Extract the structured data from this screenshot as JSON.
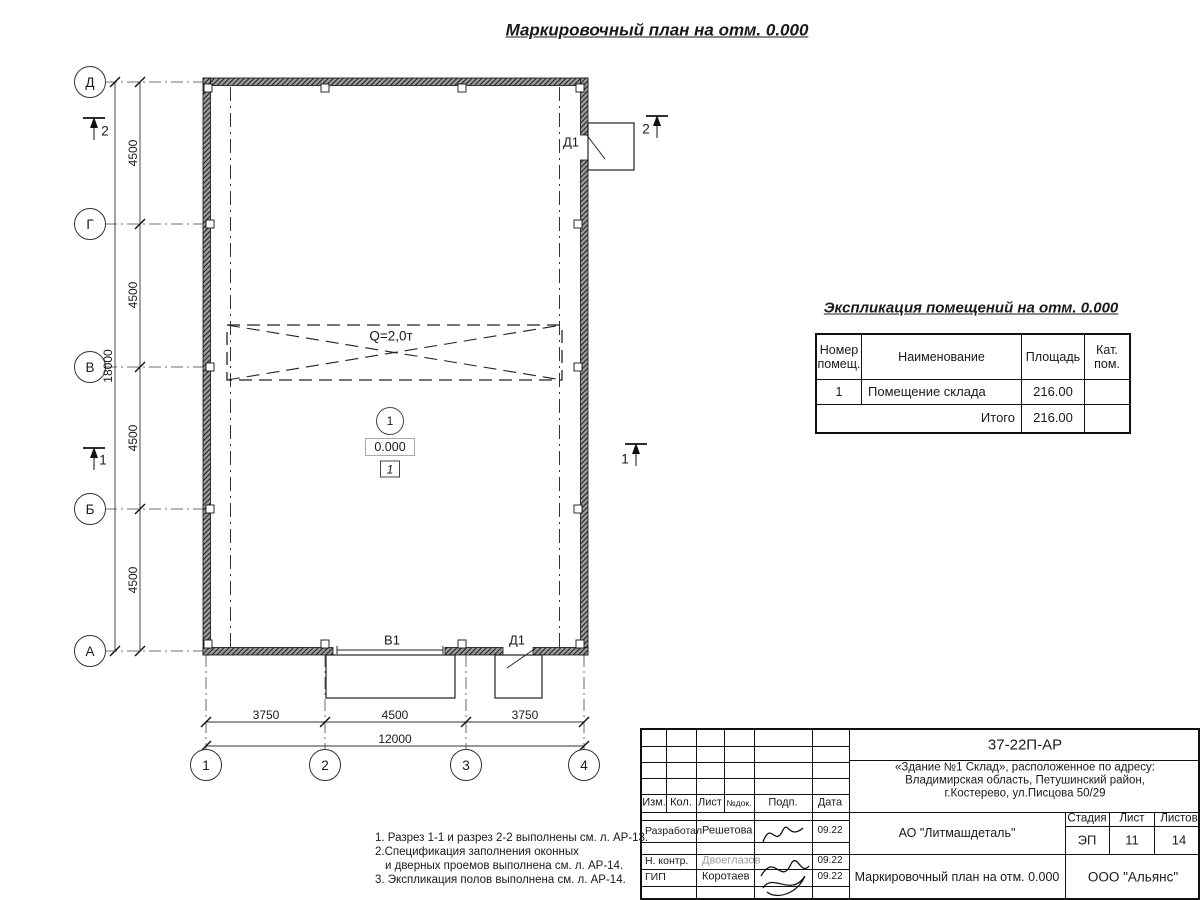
{
  "title": "Маркировочный план на отм. 0.000",
  "plan": {
    "axes_rows": [
      "Д",
      "Г",
      "В",
      "Б",
      "А"
    ],
    "axes_cols": [
      "1",
      "2",
      "3",
      "4"
    ],
    "dims_left": [
      "4500",
      "4500",
      "4500",
      "4500"
    ],
    "dim_left_total": "18000",
    "dims_bottom": [
      "3750",
      "4500",
      "3750"
    ],
    "dim_bottom_total": "12000",
    "crane_label": "Q=2,0т",
    "room_number": "1",
    "level_mark": "0.000",
    "floor_type": "1",
    "door_top_label": "Д1",
    "gate_label": "В1",
    "door_bottom_label": "Д1",
    "section_1": "1",
    "section_2": "2"
  },
  "schedule": {
    "title": "Экспликация помещений на отм. 0.000",
    "headers": [
      "Номер помещ.",
      "Наименование",
      "Площадь",
      "Кат. пом."
    ],
    "row": {
      "num": "1",
      "name": "Помещение склада",
      "area": "216.00",
      "cat": ""
    },
    "total_label": "Итого",
    "total_value": "216.00"
  },
  "notes": [
    "1. Разрез 1-1 и разрез 2-2 выполнены см. л. АР-13.",
    "2.Спецификация заполнения оконных",
    "и дверных проемов выполнена см. л. АР-14.",
    "3. Экспликация полов выполнена см. л. АР-14."
  ],
  "stamp": {
    "doc_number": "37-22П-АР",
    "address_lines": [
      "«Здание №1 Склад», расположенное по адресу:",
      "Владимирская область, Петушинский район,",
      "г.Костерево, ул.Писцова 50/29"
    ],
    "header_cols": [
      "Изм.",
      "Кол.",
      "Лист",
      "№док.",
      "Подп.",
      "Дата"
    ],
    "rows": [
      {
        "role": "Разработал",
        "name": "Решетова",
        "date": "09.22"
      },
      {
        "role": "Н. контр.",
        "name": "Двоеглазов",
        "date": "09.22"
      },
      {
        "role": "ГИП",
        "name": "Коротаев",
        "date": "09.22"
      }
    ],
    "company": "АО \"Литмашдеталь\"",
    "stage_label": "Стадия",
    "sheet_label": "Лист",
    "sheets_label": "Листов",
    "stage": "ЭП",
    "sheet": "11",
    "sheets": "14",
    "drawing_name": "Маркировочный план на отм. 0.000",
    "org": "ООО \"Альянс\""
  }
}
